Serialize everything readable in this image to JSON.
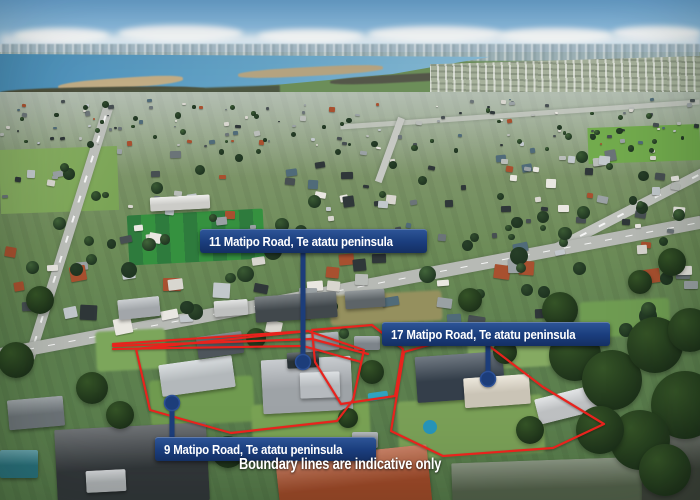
{
  "annotations": {
    "property_labels": [
      {
        "id": "11",
        "text": "11 Matipo Road, Te atatu peninsula"
      },
      {
        "id": "17",
        "text": "17 Matipo Road, Te atatu peninsula"
      },
      {
        "id": "9",
        "text": "9 Matipo Road, Te atatu peninsula"
      }
    ],
    "disclaimer": "Boundary lines are indicative only"
  },
  "colors": {
    "label_background": "#1b3e7e",
    "label_text": "#ffffff",
    "boundary_line": "#e8231d",
    "marker": "#1c3d7a"
  }
}
